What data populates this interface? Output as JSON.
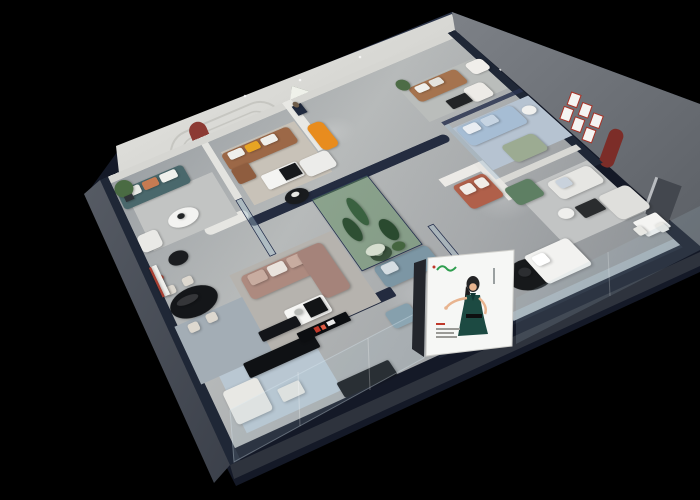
{
  "meta": {
    "description": "Isometric cutaway 3D render of a furniture showroom interior on a black background",
    "canvas": {
      "width": 700,
      "height": 500
    }
  },
  "palette": {
    "background": "#000000",
    "wall_navy": "#141927",
    "wall_navy_top": "#2b3449",
    "wall_navy_top2": "#1e2637",
    "wall_white_face": "#e9e9e5",
    "wall_white_face_dark": "#c6c6c2",
    "sage_wall": "#8ca08b",
    "right_wall": "#7d8187",
    "right_wall_dark": "#5c6066",
    "accent_red_niche": "#8c3a33",
    "accent_red_niche_right": "#7c2d28",
    "mural_green_dark": "#1f2c1e",
    "mural_green": "#44593f",
    "mural_sky": "#eff1ea",
    "poster_white": "#f6f7f5",
    "poster_logo_green": "#2f9e4f",
    "poster_dress_teal": "#1c4a42",
    "poster_skin": "#e8b48f",
    "poster_hair": "#232325",
    "plinth_light": "#565b64",
    "plinth_dark": "#3b404a",
    "plinth_bottom": "#2e333d",
    "glass_tint": "rgba(172,196,212,0.16)",
    "glass_edge": "rgba(220,234,244,0.35)",
    "accent_orange": "#e88c1e",
    "accent_yellow": "#e7a423"
  },
  "scene": {
    "plane": {
      "width": 560,
      "height": 380
    },
    "architecture": [
      {
        "n": "far-wall-base",
        "u": 0,
        "v": 0,
        "w": 560,
        "h": 12,
        "c": "#d6d6d2"
      },
      {
        "n": "left-wall-top",
        "u": 0,
        "v": 0,
        "w": 12,
        "h": 380,
        "c": "#1f2736"
      },
      {
        "n": "right-wall-top",
        "u": 548,
        "v": 0,
        "w": 12,
        "h": 255,
        "c": "#1f2736"
      },
      {
        "n": "partition-west",
        "u": 150,
        "v": 12,
        "w": 10,
        "h": 98,
        "c": "#e3e3df"
      },
      {
        "n": "mural-wall-top",
        "u": 282,
        "v": 0,
        "w": 14,
        "h": 92,
        "c": "#e8e8e4"
      },
      {
        "n": "mid-curved-wall",
        "u": 150,
        "v": 140,
        "w": 285,
        "h": 13,
        "c": "#242c40",
        "r": 8
      },
      {
        "n": "curve-wall-white",
        "u": 95,
        "v": 126,
        "w": 60,
        "h": 15,
        "c": "#e6e6e2",
        "r": 12
      },
      {
        "n": "front-wall",
        "u": 40,
        "v": 285,
        "w": 212,
        "h": 12,
        "c": "#232b3f",
        "r": 2
      },
      {
        "n": "east-partition",
        "u": 428,
        "v": 222,
        "w": 126,
        "h": 8,
        "c": "#d8d8d4"
      },
      {
        "n": "display-wall-a",
        "u": 385,
        "v": 193,
        "w": 62,
        "h": 12,
        "c": "#eceae6"
      },
      {
        "n": "display-wall-b",
        "u": 435,
        "v": 193,
        "w": 12,
        "h": 58,
        "c": "#e8e6e2"
      }
    ],
    "rugs": [
      {
        "n": "rug-west-striped",
        "u": 25,
        "v": 58,
        "w": 118,
        "h": 72,
        "c": "#c2c4c3",
        "rug": true
      },
      {
        "n": "rug-brown-room",
        "u": 168,
        "v": 35,
        "w": 112,
        "h": 92,
        "c": "#c8c2b8"
      },
      {
        "n": "rug-north-room",
        "u": 430,
        "v": 55,
        "w": 118,
        "h": 62,
        "c": "#babdbb"
      },
      {
        "n": "rug-nook-blue",
        "u": 448,
        "v": 138,
        "w": 112,
        "h": 72,
        "c": "#b6c3d1"
      },
      {
        "n": "rug-east-room",
        "u": 448,
        "v": 245,
        "w": 100,
        "h": 78,
        "c": "#c2c4c4"
      },
      {
        "n": "rug-mauve-room",
        "u": 95,
        "v": 198,
        "w": 138,
        "h": 98,
        "c": "#b6b3ae"
      },
      {
        "n": "rug-dining-striped",
        "u": 8,
        "v": 228,
        "w": 88,
        "h": 70,
        "c": "#a3adb5",
        "rug": true
      },
      {
        "n": "rug-south-striped",
        "u": 30,
        "v": 298,
        "w": 112,
        "h": 62,
        "c": "#b9c7d2",
        "rug": true
      },
      {
        "n": "rug-round-black",
        "s": "e",
        "u": 366,
        "v": 316,
        "w": 52,
        "h": 34,
        "c": "#17191b"
      }
    ],
    "furniture": [
      {
        "n": "teal-sofa",
        "u": 14,
        "v": 28,
        "w": 98,
        "h": 32,
        "c": "#4a686c",
        "r": 6
      },
      {
        "n": "teal-sofa-cushion-white",
        "u": 22,
        "v": 30,
        "w": 24,
        "h": 14,
        "c": "#e9e9e5",
        "r": 3
      },
      {
        "n": "teal-sofa-cushion-terracotta",
        "u": 50,
        "v": 30,
        "w": 22,
        "h": 14,
        "c": "#c77b52",
        "r": 3
      },
      {
        "n": "teal-sofa-cushion-white-2",
        "u": 76,
        "v": 30,
        "w": 24,
        "h": 14,
        "c": "#eff0ec",
        "r": 3
      },
      {
        "n": "coffee-table-west",
        "s": "e",
        "u": 58,
        "v": 90,
        "w": 42,
        "h": 26,
        "c": "#f3f3f1"
      },
      {
        "n": "vase-west",
        "s": "e",
        "u": 72,
        "v": 96,
        "w": 10,
        "h": 8,
        "c": "#222527"
      },
      {
        "n": "plant-west",
        "s": "e",
        "u": 12,
        "v": 14,
        "w": 26,
        "h": 28,
        "c": "#4a6b43"
      },
      {
        "n": "plant-pot-west",
        "u": 20,
        "v": 40,
        "w": 12,
        "h": 9,
        "c": "#2e3237"
      },
      {
        "n": "side-table-black-west",
        "s": "e",
        "u": 36,
        "v": 142,
        "w": 26,
        "h": 19,
        "c": "#1b1d20"
      },
      {
        "n": "armchair-west",
        "u": 12,
        "v": 102,
        "w": 28,
        "h": 26,
        "c": "#e9e9e6",
        "r": 6
      },
      {
        "n": "brown-leather-sofa",
        "u": 166,
        "v": 38,
        "w": 102,
        "h": 30,
        "c": "#9c6847",
        "r": 6
      },
      {
        "n": "brown-sofa-cushion-white",
        "u": 174,
        "v": 40,
        "w": 22,
        "h": 13,
        "c": "#efefeb",
        "r": 3
      },
      {
        "n": "brown-sofa-cushion-yellow",
        "u": 200,
        "v": 40,
        "w": 20,
        "h": 13,
        "c": "#e7a423",
        "r": 3
      },
      {
        "n": "brown-sofa-cushion-white-2",
        "u": 224,
        "v": 40,
        "w": 22,
        "h": 13,
        "c": "#efefeb",
        "r": 3
      },
      {
        "n": "brown-chaise",
        "u": 166,
        "v": 66,
        "w": 26,
        "h": 26,
        "c": "#8f5d3f",
        "r": 4
      },
      {
        "n": "marble-coffee-table",
        "u": 196,
        "v": 92,
        "w": 52,
        "h": 24,
        "c": "#f4f4f2",
        "r": 3
      },
      {
        "n": "marble-table-black-box",
        "u": 222,
        "v": 94,
        "w": 24,
        "h": 19,
        "c": "#17191c"
      },
      {
        "n": "white-sofa-brown-room",
        "u": 250,
        "v": 94,
        "w": 42,
        "h": 28,
        "c": "#ececea",
        "r": 6
      },
      {
        "n": "round-table-black",
        "s": "e",
        "u": 206,
        "v": 128,
        "w": 32,
        "h": 21,
        "c": "#191b1e"
      },
      {
        "n": "round-table-decor",
        "s": "e",
        "u": 216,
        "v": 132,
        "w": 11,
        "h": 7,
        "c": "#e6e6e2"
      },
      {
        "n": "orange-chaise",
        "u": 288,
        "v": 50,
        "w": 24,
        "h": 46,
        "c": "#e88c1e",
        "r": 8
      },
      {
        "n": "sculpture-pedestal",
        "u": 290,
        "v": 12,
        "w": 14,
        "h": 18,
        "c": "#202a3e"
      },
      {
        "n": "bronze-sculpture",
        "s": "e",
        "u": 293,
        "v": 6,
        "w": 8,
        "h": 11,
        "c": "#6f5e4b"
      },
      {
        "n": "caramel-sofa",
        "u": 440,
        "v": 58,
        "w": 74,
        "h": 28,
        "c": "#a5734e",
        "r": 6
      },
      {
        "n": "caramel-cushion-a",
        "u": 448,
        "v": 60,
        "w": 18,
        "h": 12,
        "c": "#f0f0ec",
        "r": 3
      },
      {
        "n": "caramel-cushion-b",
        "u": 470,
        "v": 60,
        "w": 18,
        "h": 12,
        "c": "#e4e2dc",
        "r": 3
      },
      {
        "n": "armchair-north",
        "u": 498,
        "v": 92,
        "w": 30,
        "h": 26,
        "c": "#edebe7",
        "r": 6
      },
      {
        "n": "slipper-chair-north",
        "u": 528,
        "v": 58,
        "w": 26,
        "h": 22,
        "c": "#f0eeea",
        "r": 6
      },
      {
        "n": "coffee-table-north",
        "u": 468,
        "v": 98,
        "w": 30,
        "h": 16,
        "c": "#222426",
        "r": 2
      },
      {
        "n": "plant-north",
        "s": "e",
        "u": 430,
        "v": 40,
        "w": 18,
        "h": 20,
        "c": "#4d6c46"
      },
      {
        "n": "blue-sofa",
        "u": 450,
        "v": 140,
        "w": 82,
        "h": 32,
        "c": "#a6bdd4",
        "r": 6
      },
      {
        "n": "blue-sofa-cushion-a",
        "u": 458,
        "v": 142,
        "w": 20,
        "h": 13,
        "c": "#e9edf2",
        "r": 3
      },
      {
        "n": "blue-sofa-cushion-b",
        "u": 484,
        "v": 142,
        "w": 20,
        "h": 13,
        "c": "#c6d4e2",
        "r": 3
      },
      {
        "n": "sage-loveseat",
        "u": 478,
        "v": 186,
        "w": 46,
        "h": 28,
        "c": "#9cab92",
        "r": 6
      },
      {
        "n": "side-table-nook",
        "s": "e",
        "u": 536,
        "v": 150,
        "w": 18,
        "h": 14,
        "c": "#f0f0ee"
      },
      {
        "n": "green-velvet-sofa",
        "u": 440,
        "v": 236,
        "w": 36,
        "h": 26,
        "c": "#5e7f63",
        "r": 5
      },
      {
        "n": "white-sofa-east-a",
        "u": 486,
        "v": 250,
        "w": 58,
        "h": 26,
        "c": "#e6e6e3",
        "r": 6
      },
      {
        "n": "east-cushion-blue",
        "u": 496,
        "v": 252,
        "w": 16,
        "h": 12,
        "c": "#c9d2dc",
        "r": 3
      },
      {
        "n": "white-sofa-east-b",
        "u": 520,
        "v": 288,
        "w": 40,
        "h": 34,
        "c": "#dfdfdc",
        "r": 6
      },
      {
        "n": "coffee-table-east",
        "u": 490,
        "v": 288,
        "w": 28,
        "h": 16,
        "c": "#2a2c2e",
        "r": 2
      },
      {
        "n": "side-table-east",
        "s": "e",
        "u": 468,
        "v": 284,
        "w": 18,
        "h": 13,
        "c": "#efefed"
      },
      {
        "n": "dining-table-east",
        "u": 528,
        "v": 328,
        "w": 30,
        "h": 20,
        "c": "#f4f4f2",
        "r": 2
      },
      {
        "n": "dining-chair-east-a",
        "u": 522,
        "v": 334,
        "w": 10,
        "h": 10,
        "c": "#e8e8e4",
        "r": 2
      },
      {
        "n": "dining-chair-east-b",
        "u": 544,
        "v": 340,
        "w": 10,
        "h": 10,
        "c": "#e8e8e4",
        "r": 2
      },
      {
        "n": "bed-white",
        "u": 400,
        "v": 314,
        "w": 56,
        "h": 36,
        "c": "#f2f2f0",
        "r": 4
      },
      {
        "n": "bed-pillow",
        "u": 406,
        "v": 318,
        "w": 16,
        "h": 12,
        "c": "#ffffff",
        "r": 3
      },
      {
        "n": "rug-decor-black",
        "s": "e",
        "u": 382,
        "v": 324,
        "w": 14,
        "h": 10,
        "c": "#2c2e31"
      },
      {
        "n": "mauve-sectional",
        "u": 105,
        "v": 205,
        "w": 102,
        "h": 32,
        "c": "#ad8a7f",
        "r": 6
      },
      {
        "n": "mauve-cushion-a",
        "u": 113,
        "v": 207,
        "w": 22,
        "h": 14,
        "c": "#c8aca0",
        "r": 3
      },
      {
        "n": "mauve-cushion-b",
        "u": 139,
        "v": 207,
        "w": 22,
        "h": 14,
        "c": "#e9e3dd",
        "r": 3
      },
      {
        "n": "mauve-cushion-c",
        "u": 165,
        "v": 207,
        "w": 20,
        "h": 14,
        "c": "#c8aca0",
        "r": 3
      },
      {
        "n": "mauve-chaise",
        "u": 180,
        "v": 205,
        "w": 34,
        "h": 64,
        "c": "#a5837a",
        "r": 6
      },
      {
        "n": "coffee-table-mauve",
        "u": 130,
        "v": 262,
        "w": 50,
        "h": 22,
        "c": "#f6f6f4",
        "r": 3
      },
      {
        "n": "coffee-table-mauve-dark",
        "u": 154,
        "v": 264,
        "w": 22,
        "h": 17,
        "c": "#121416"
      },
      {
        "n": "coffee-decor-mauve",
        "s": "e",
        "u": 140,
        "v": 266,
        "w": 10,
        "h": 7,
        "c": "#b7b9b6"
      },
      {
        "n": "bluegray-sofa-a",
        "u": 248,
        "v": 258,
        "w": 70,
        "h": 28,
        "c": "#7c96a4",
        "r": 6
      },
      {
        "n": "bluegray-cushion",
        "u": 256,
        "v": 260,
        "w": 18,
        "h": 12,
        "c": "#d5dde2",
        "r": 3
      },
      {
        "n": "bluegray-sofa-b",
        "u": 294,
        "v": 298,
        "w": 40,
        "h": 40,
        "c": "#7f99a6",
        "r": 6
      },
      {
        "n": "bluegray-ottoman",
        "u": 228,
        "v": 308,
        "w": 30,
        "h": 20,
        "c": "#86a0ad",
        "r": 4
      },
      {
        "n": "round-table-black-south",
        "s": "e",
        "u": 254,
        "v": 238,
        "w": 26,
        "h": 18,
        "c": "#141618"
      },
      {
        "n": "decor-south",
        "s": "e",
        "u": 260,
        "v": 242,
        "w": 10,
        "h": 7,
        "c": "#dcdcd8"
      },
      {
        "n": "dining-oval-table",
        "s": "e",
        "u": 12,
        "v": 192,
        "w": 60,
        "h": 36,
        "c": "#141619"
      },
      {
        "n": "dining-table-sheen",
        "s": "e",
        "u": 22,
        "v": 200,
        "w": 28,
        "h": 10,
        "c": "rgba(255,255,255,0.14)"
      },
      {
        "n": "dining-chair-a",
        "u": 16,
        "v": 180,
        "w": 13,
        "h": 11,
        "c": "#ddd8cf",
        "r": 3
      },
      {
        "n": "dining-chair-b",
        "u": 40,
        "v": 178,
        "w": 13,
        "h": 11,
        "c": "#ddd8cf",
        "r": 3
      },
      {
        "n": "dining-chair-c",
        "u": 22,
        "v": 232,
        "w": 13,
        "h": 11,
        "c": "#ddd8cf",
        "r": 3
      },
      {
        "n": "dining-chair-d",
        "u": 46,
        "v": 230,
        "w": 13,
        "h": 11,
        "c": "#ddd8cf",
        "r": 3
      },
      {
        "n": "red-floor-lamp-stem",
        "u": 16,
        "v": 166,
        "w": 4,
        "h": 24,
        "c": "#b23f2e"
      },
      {
        "n": "red-floor-lamp-head",
        "s": "e",
        "u": 10,
        "v": 162,
        "w": 12,
        "h": 8,
        "c": "#b23f2e"
      },
      {
        "n": "shelf-unit-white",
        "u": 10,
        "v": 148,
        "w": 10,
        "h": 42,
        "c": "#efefec"
      },
      {
        "n": "shelf-red-trim",
        "u": 10,
        "v": 148,
        "w": 3,
        "h": 42,
        "c": "#a84033"
      },
      {
        "n": "media-console-a",
        "u": 60,
        "v": 296,
        "w": 86,
        "h": 17,
        "c": "#0f1114",
        "r": 2
      },
      {
        "n": "media-console-b",
        "u": 140,
        "v": 352,
        "w": 62,
        "h": 16,
        "c": "#101216",
        "r": 2
      },
      {
        "n": "media-console-c",
        "u": 92,
        "v": 272,
        "w": 48,
        "h": 12,
        "c": "#131519",
        "r": 2
      },
      {
        "n": "logo-ledge-black",
        "u": 130,
        "v": 290,
        "w": 62,
        "h": 11,
        "c": "#0c0e11",
        "r": 1
      },
      {
        "n": "logo-ledge-red-a",
        "u": 150,
        "v": 292,
        "w": 6,
        "h": 6,
        "c": "#c0392b"
      },
      {
        "n": "logo-ledge-red-b",
        "u": 158,
        "v": 293,
        "w": 5,
        "h": 5,
        "c": "#e05c44"
      },
      {
        "n": "logo-ledge-white",
        "u": 166,
        "v": 292,
        "w": 9,
        "h": 5,
        "c": "#e8e8e8"
      },
      {
        "n": "white-corner-seat",
        "u": 25,
        "v": 314,
        "w": 42,
        "h": 36,
        "c": "#e8e8e4",
        "r": 4
      },
      {
        "n": "white-coffee-south",
        "u": 80,
        "v": 334,
        "w": 26,
        "h": 14,
        "c": "#e6e6e2",
        "r": 2
      },
      {
        "n": "terracotta-display-sofa",
        "u": 392,
        "v": 208,
        "w": 44,
        "h": 36,
        "c": "#b0604a",
        "r": 5
      },
      {
        "n": "terracotta-cushion-a",
        "u": 398,
        "v": 212,
        "w": 16,
        "h": 13,
        "c": "#f1ede8",
        "r": 3
      },
      {
        "n": "terracotta-cushion-b",
        "u": 418,
        "v": 212,
        "w": 14,
        "h": 13,
        "c": "#f1ede8",
        "r": 3
      },
      {
        "n": "atrium-green-floor",
        "u": 235,
        "v": 150,
        "w": 78,
        "h": 105,
        "c": "rgba(96,140,96,0.5)",
        "k": "#263150"
      },
      {
        "n": "cactus-a",
        "s": "e",
        "u": 248,
        "v": 190,
        "w": 16,
        "h": 34,
        "c": "#2e4f33"
      },
      {
        "n": "cactus-b",
        "s": "e",
        "u": 268,
        "v": 168,
        "w": 14,
        "h": 42,
        "c": "#3a6140"
      },
      {
        "n": "cactus-c",
        "s": "e",
        "u": 284,
        "v": 210,
        "w": 18,
        "h": 30,
        "c": "#2a4a2f"
      },
      {
        "n": "white-flowers",
        "s": "e",
        "u": 252,
        "v": 234,
        "w": 24,
        "h": 13,
        "c": "#d6decf"
      },
      {
        "n": "shrub",
        "s": "e",
        "u": 282,
        "v": 242,
        "w": 16,
        "h": 11,
        "c": "#44653f"
      }
    ],
    "glazing": [
      {
        "n": "glass-partition-west",
        "u": 150,
        "v": 110,
        "w": 7,
        "h": 85,
        "c": "rgba(168,194,210,0.4)",
        "k": "#2a3450"
      },
      {
        "n": "nook-glass-top",
        "u": 442,
        "v": 124,
        "w": 118,
        "h": 6,
        "c": "#2a3450",
        "o": 0.85
      },
      {
        "n": "nook-glass-side",
        "u": 442,
        "v": 130,
        "w": 6,
        "h": 92,
        "c": "rgba(168,194,210,0.45)"
      },
      {
        "n": "se-glass-partition",
        "u": 334,
        "v": 240,
        "w": 6,
        "h": 128,
        "c": "rgba(168,194,210,0.35)",
        "k": "#2a3450"
      },
      {
        "n": "front-glass-band",
        "u": 250,
        "v": 360,
        "w": 298,
        "h": 8,
        "c": "rgba(190,212,226,0.4)"
      },
      {
        "n": "front-glass-frame",
        "u": 250,
        "v": 368,
        "w": 298,
        "h": 3,
        "c": "#1c2333"
      }
    ]
  },
  "graphics": {
    "arched_niches_count": 3,
    "mini_red_frames_count": 6,
    "billboard": {
      "figure": "illustrated woman in dark teal dress",
      "logo_color": "#2f9e4f"
    },
    "forest_mural": {
      "theme": "pine forest photo mural"
    }
  }
}
